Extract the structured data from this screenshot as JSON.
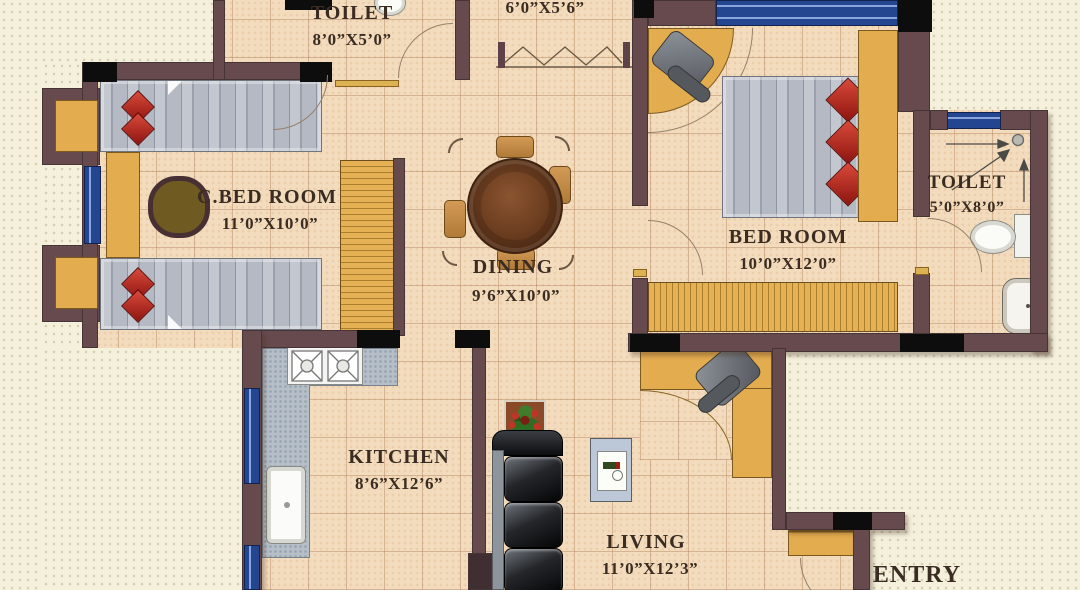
{
  "rooms": [
    {
      "id": "toilet-top",
      "name": "TOILET",
      "dims": "8’0”X5’0”"
    },
    {
      "id": "dress",
      "name": "",
      "dims": "6’0”X5’6”"
    },
    {
      "id": "c-bed-room",
      "name": "C.BED ROOM",
      "dims": "11’0”X10’0”"
    },
    {
      "id": "dining",
      "name": "DINING",
      "dims": "9’6”X10’0”"
    },
    {
      "id": "bed-room",
      "name": "BED ROOM",
      "dims": "10’0”X12’0”"
    },
    {
      "id": "toilet-right",
      "name": "TOILET",
      "dims": "5’0”X8’0”"
    },
    {
      "id": "kitchen",
      "name": "KITCHEN",
      "dims": "8’6”X12’6”"
    },
    {
      "id": "living",
      "name": "LIVING",
      "dims": "11’0”X12’3”"
    },
    {
      "id": "entry",
      "name": "ENTRY",
      "dims": ""
    }
  ],
  "colors": {
    "wall": "#664a4e",
    "pillar": "#0e0d0d",
    "floor": "#f3dcbd",
    "outside": "#f4f0dc",
    "window_blue": "#24458f",
    "furniture_yellow": "#e3ac4f",
    "pillow_red": "#b32a1e",
    "label_text": "#3a2c22",
    "sofa_black": "#0a0a0a",
    "counter_gray": "#b6bfc8"
  }
}
